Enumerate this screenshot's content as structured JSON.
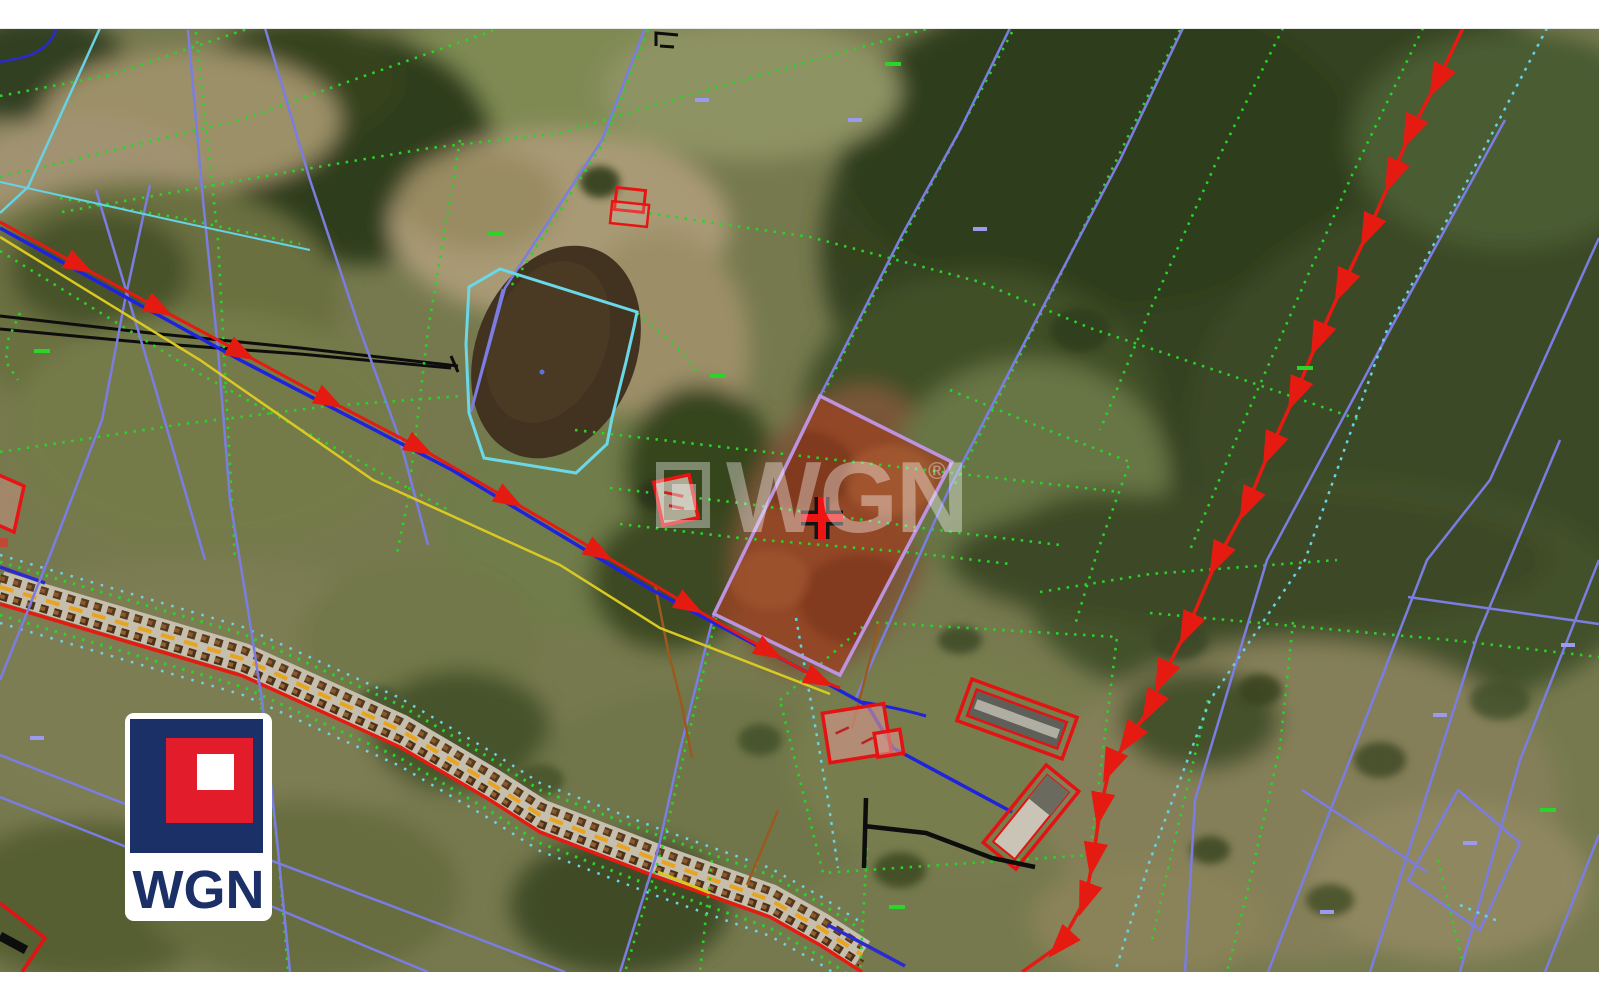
{
  "image": {
    "kind": "aerial-cadastral-map-listing-photo",
    "width_px": 1599,
    "height_px": 999
  },
  "watermark": {
    "text": "WGN",
    "registered_mark": "®"
  },
  "brand_logo": {
    "text": "WGN"
  },
  "map": {
    "marker": {
      "type": "cross",
      "meaning": "highlighted-parcel-location"
    },
    "highlighted_parcel": {
      "present": true,
      "shape": "quadrilateral"
    },
    "visible_features": [
      "green-dotted-parcel-boundaries",
      "blue-violet-cadastral-lines",
      "red-utility-line-with-arrows",
      "blue-utility-line",
      "yellow-utility-line",
      "railway-corridor-band",
      "cyan-pond-outline",
      "red-building-outlines",
      "black-power-line",
      "pond"
    ]
  },
  "colors": {
    "brand_navy": "#1b3066",
    "brand_red": "#e31c2b",
    "marker_red": "#ef1313",
    "parcel_fill": "#9a4423",
    "parcel_border": "#bb93de",
    "boundary_green": "#29d429",
    "cadastral_blue": "#7b7de2",
    "utility_red": "#e51b12",
    "utility_blue": "#1f24dc",
    "utility_yellow": "#d9c922",
    "cyan_line": "#66d2e2"
  }
}
